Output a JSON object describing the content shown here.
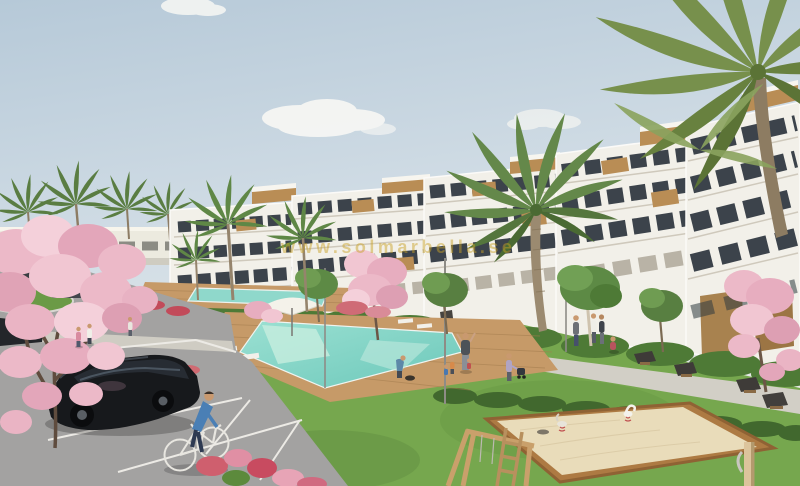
{
  "image": {
    "width": 800,
    "height": 486,
    "subject": "CGI exterior render of a white terraced new-build apartment complex with communal pools, lawns, palm trees, pink blossom trees, a playground sandbox, parking lot with a black car and a cyclist"
  },
  "watermark": {
    "text": "www.solmarbella.se"
  },
  "palette": {
    "sky_top": "#b9cbd9",
    "sky_bottom": "#e7e9e7",
    "cloud": "#f8f8f5",
    "building": "#f2f0e9",
    "building_shadow": "#d9d5c9",
    "glass": "#3c434b",
    "wood": "#b98d55",
    "palm": "#64884a",
    "grass": "#76a74e",
    "hedge": "#41682e",
    "blossom": "#ecb9c8",
    "pool": "#82d4c6",
    "deck": "#c69a68",
    "path": "#d2cfc6",
    "asphalt": "#a3a2a1",
    "line": "#eceae5",
    "sand": "#e9dcba",
    "frame_wood": "#ad7a43",
    "car": "#17191c",
    "bench": "#3e3b38",
    "watermark_gold": "#c9a227"
  }
}
